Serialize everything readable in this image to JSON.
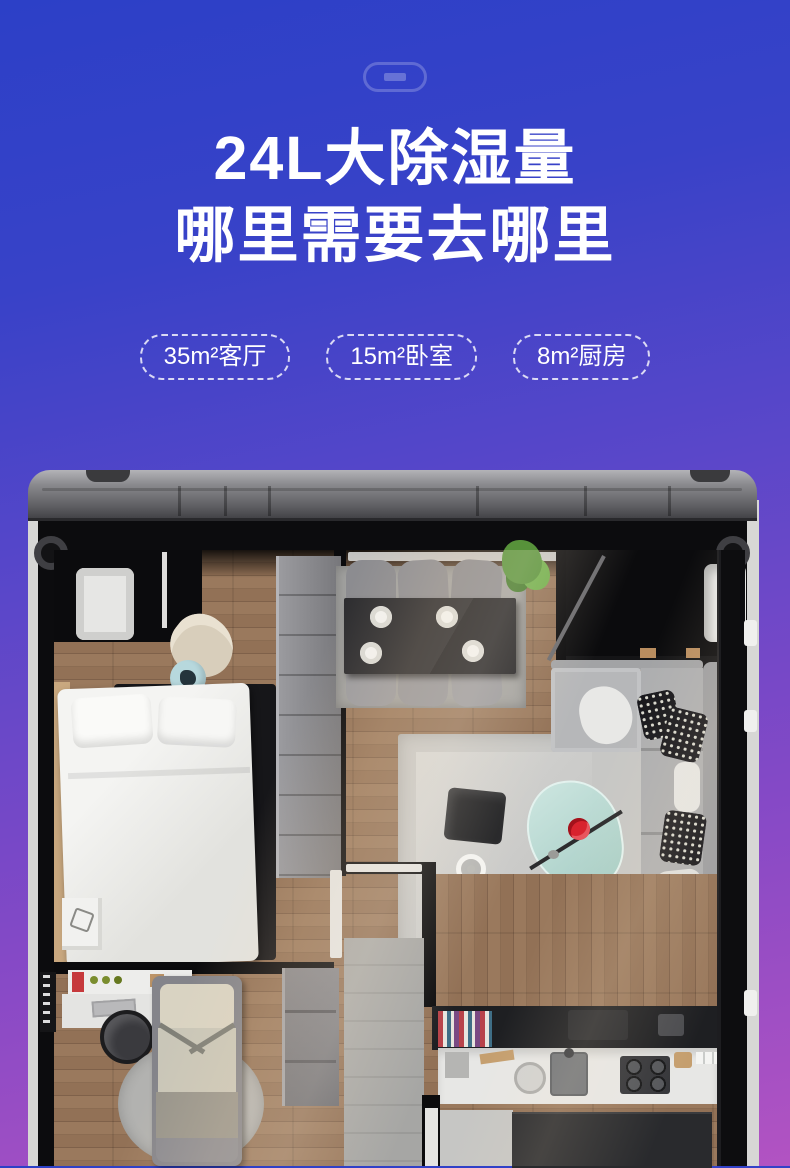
{
  "page": {
    "gradient_top": "#2c40c7",
    "gradient_middle": "#6449c8",
    "gradient_bottom": "#b253c2"
  },
  "hero": {
    "device_icon": "dehumidifier-pill-outline-icon",
    "title_line1": "24L大除湿量",
    "title_line2": "哪里需要去哪里",
    "badges": [
      {
        "label": "35m²客厅"
      },
      {
        "label": "15m²卧室"
      },
      {
        "label": "8m²厨房"
      }
    ]
  },
  "floorplan": {
    "type": "illustration",
    "content": "top-down-3d-apartment-render",
    "rooms": [
      "bedroom",
      "dining-area",
      "living-room",
      "entryway",
      "bathroom",
      "study-bedroom",
      "kitchen"
    ],
    "palette": {
      "wood_floor": "#8f7057",
      "walls": "#0c0c0e",
      "outer_wall": "#d7d7d5",
      "sofa": "#b0b1b3",
      "accent_flower": "#d8232e",
      "glass_table": "#bfe0da"
    }
  }
}
